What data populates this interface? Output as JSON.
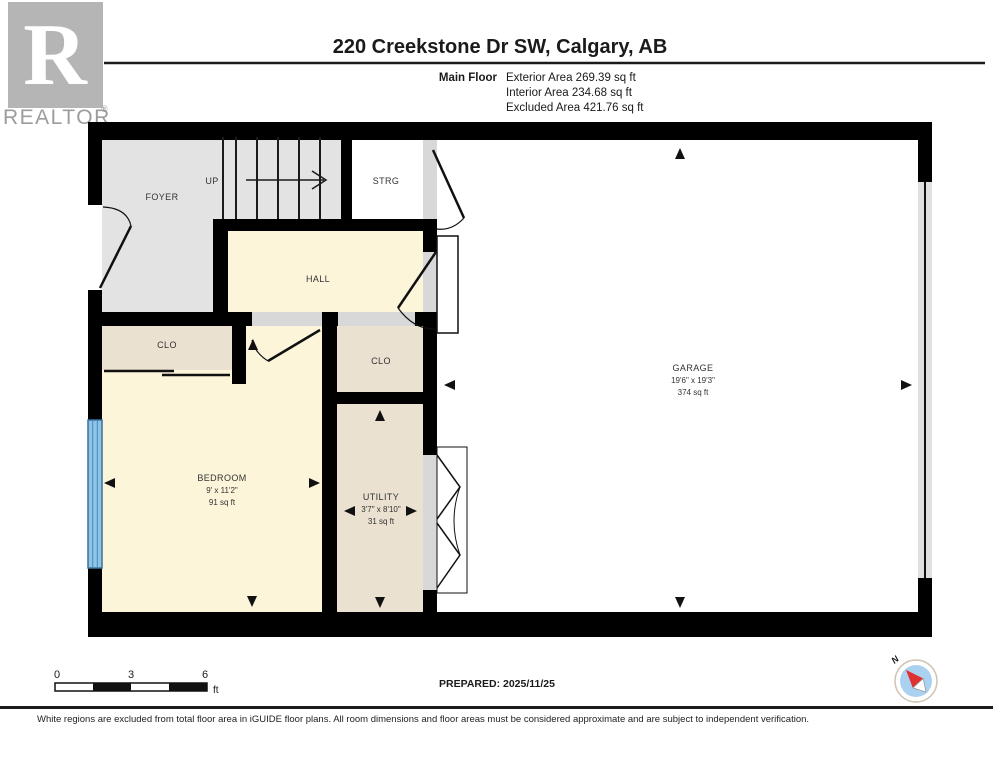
{
  "logo": {
    "letter": "R",
    "brand": "REALTOR",
    "reg": "®"
  },
  "header": {
    "title": "220 Creekstone Dr SW, Calgary, AB",
    "floor_label": "Main Floor",
    "stats": [
      "Exterior Area 269.39 sq ft",
      "Interior Area 234.68 sq ft",
      "Excluded Area 421.76 sq ft"
    ]
  },
  "rooms": {
    "foyer": {
      "name": "FOYER"
    },
    "stairs": {
      "direction_label": "UP"
    },
    "strg": {
      "name": "STRG"
    },
    "hall": {
      "name": "HALL"
    },
    "clo_left": {
      "name": "CLO"
    },
    "clo_right": {
      "name": "CLO"
    },
    "bedroom": {
      "name": "BEDROOM",
      "dims": "9' x 11'2\"",
      "area": "91 sq ft"
    },
    "utility": {
      "name": "UTILITY",
      "dims": "3'7\" x 8'10\"",
      "area": "31 sq ft"
    },
    "garage": {
      "name": "GARAGE",
      "dims": "19'6\" x 19'3\"",
      "area": "374 sq ft"
    }
  },
  "scale_bar": {
    "tick0": "0",
    "tick3": "3",
    "tick6": "6",
    "unit": "ft"
  },
  "prepared": "PREPARED: 2025/11/25",
  "compass": {
    "north_label": "N"
  },
  "footer": "White regions are excluded from total floor area in iGUIDE floor plans. All room dimensions and floor areas must be considered approximate and are subject to independent verification.",
  "colors": {
    "wall": "#000000",
    "floor_gray": "#e3e3e3",
    "threshold_gray": "#d8d8d8",
    "floor_cream": "#fcf5da",
    "floor_tan": "#eae1d1",
    "garage_white": "#ffffff",
    "window_blue": "#8ec4e8",
    "window_border": "#39729f",
    "compass_blue": "#aad2f0",
    "compass_red": "#e03131",
    "logo_gray": "#b5b5b5"
  }
}
